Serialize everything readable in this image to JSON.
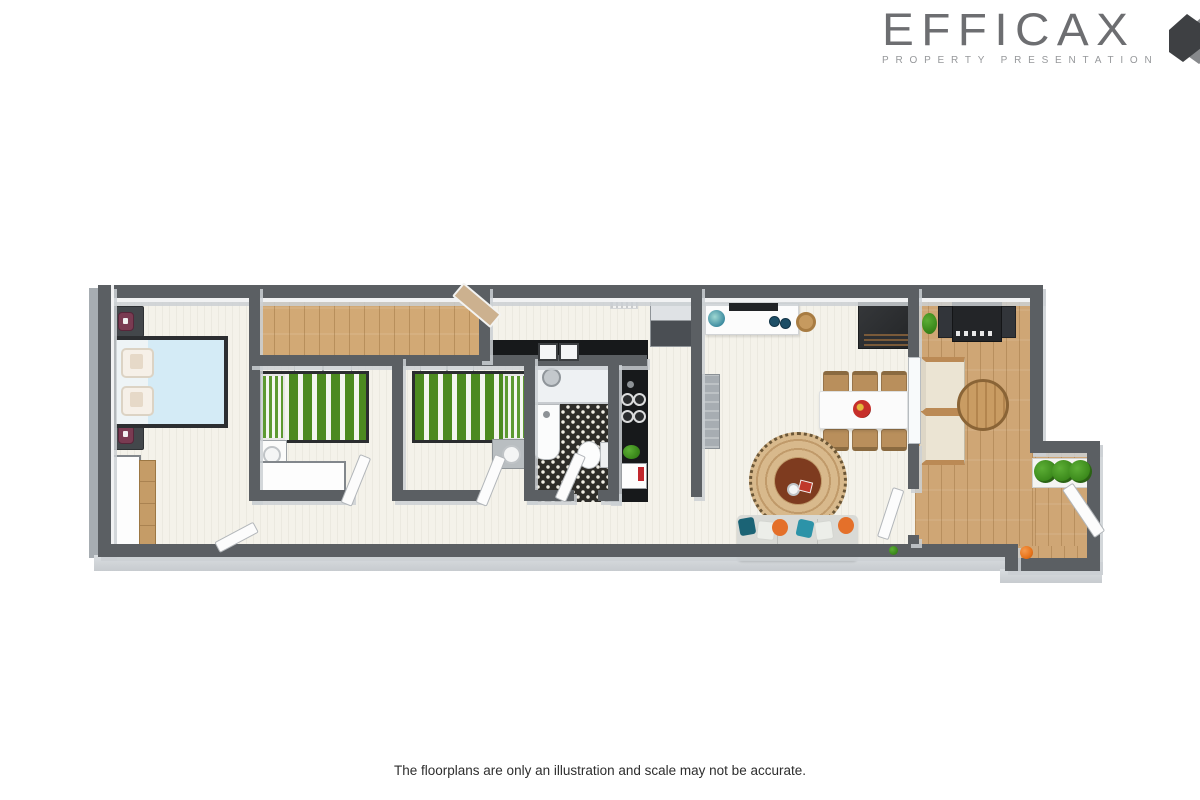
{
  "logo": {
    "name": "EFFICAX",
    "tagline": "PROPERTY PRESENTATION",
    "wordmark_color": "#6d6e71",
    "tagline_color": "#96989b",
    "mark_colors": [
      "#3e4043",
      "#87898c",
      "#c0c2c4"
    ]
  },
  "footer": {
    "disclaimer": "The floorplans are only an illustration and scale may not be accurate."
  },
  "floorplan": {
    "style": "3d-top-down-render",
    "colors": {
      "page_bg": "#ffffff",
      "wall": "#5b5f63",
      "wall_face": "#d3d7da",
      "floor_interior": "#f4f2ea",
      "floor_wood": "#d2a975",
      "floor_deck": "#cfa675",
      "tile_base": "#2e2d29",
      "tile_dot": "#f1efe6",
      "bed_blue": "#d4ebf6",
      "bed_green": "#4c8a20",
      "rug_outer": "#d8b98c",
      "rug_inner": "#7e3b1f",
      "sofa": "#d9dad6",
      "pillow_teal": "#2c93a8",
      "pillow_orange": "#e4702a",
      "wordmark": "#6d6e71",
      "tagline": "#96989b"
    },
    "rooms": [
      {
        "name": "master-bedroom",
        "floor": "whitewashed-wood",
        "furniture": [
          "double-bed-light-blue",
          "nightstand-with-lamp",
          "nightstand-with-lamp",
          "white-wardrobe",
          "wood-dresser",
          "open-door"
        ]
      },
      {
        "name": "bedroom-1",
        "floor": "whitewashed-wood",
        "furniture": [
          "single-bed-green-striped",
          "nightstand",
          "built-in-wardrobe",
          "wall-radiator",
          "open-door"
        ]
      },
      {
        "name": "bedroom-2",
        "floor": "whitewashed-wood",
        "furniture": [
          "single-bed-green-striped",
          "nightstand",
          "wall-radiator",
          "open-door"
        ]
      },
      {
        "name": "study-nook",
        "floor": "wood",
        "furniture": [
          "open-door"
        ]
      },
      {
        "name": "bathroom",
        "floor": "black-white-patterned-tile",
        "furniture": [
          "walk-in-shower",
          "vanity-basin",
          "toilet",
          "open-door"
        ]
      },
      {
        "name": "kitchen",
        "floor": "whitewashed-wood",
        "furniture": [
          "l-shaped-black-counter",
          "double-sink",
          "cooktop-4-burner",
          "refrigerator",
          "coffee-machine",
          "counter-plant",
          "floor-vent"
        ]
      },
      {
        "name": "living-dining",
        "floor": "whitewashed-wood",
        "furniture": [
          "sideboard-with-decor",
          "globe",
          "soundbar",
          "decor-plates",
          "wicker-basket",
          "tall-black-cabinet",
          "dining-table",
          "six-wood-chairs",
          "fruit-bowl",
          "round-jute-rug",
          "coffee-cup",
          "red-book",
          "gray-sofa-with-pillows",
          "concrete-console",
          "glass-door-to-deck"
        ]
      },
      {
        "name": "hallway",
        "floor": "whitewashed-wood",
        "furniture": []
      },
      {
        "name": "deck",
        "floor": "deck-wood",
        "furniture": [
          "bbq-grill",
          "armchair",
          "armchair",
          "round-wood-table",
          "planter-with-three-bushes",
          "potted-plant",
          "orange-ball",
          "gate-door"
        ]
      }
    ]
  }
}
